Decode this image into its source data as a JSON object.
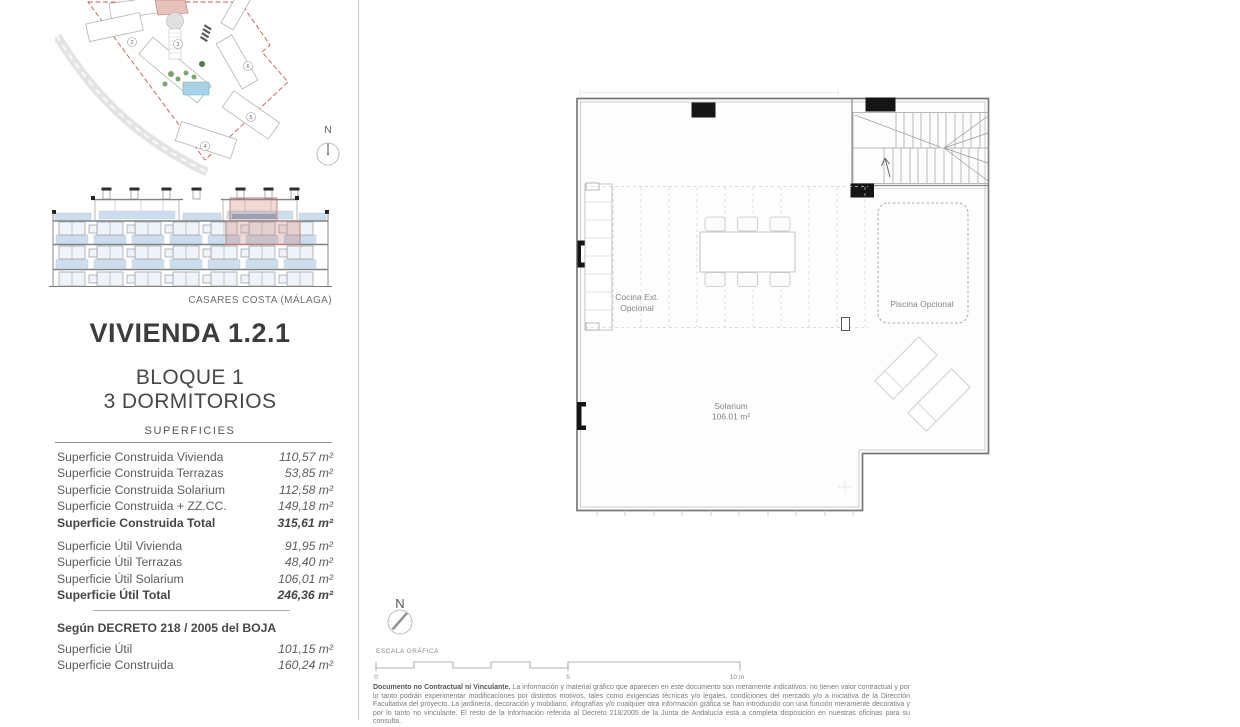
{
  "location": "CASARES COSTA (MÁLAGA)",
  "title": "VIVIENDA 1.2.1",
  "subtitle_block": "BLOQUE 1",
  "subtitle_bedrooms": "3 DORMITORIOS",
  "surfaces": {
    "header": "SUPERFICIES",
    "built": [
      {
        "label": "Superficie Construida Vivienda",
        "value": "110,57 m²"
      },
      {
        "label": "Superficie Construida Terrazas",
        "value": "53,85 m²"
      },
      {
        "label": "Superficie Construida Solarium",
        "value": "112,58 m²"
      },
      {
        "label": "Superficie Construida + ZZ.CC.",
        "value": "149,18 m²"
      },
      {
        "label": "Superficie Construida Total",
        "value": "315,61 m²"
      }
    ],
    "useful": [
      {
        "label": "Superficie Útil Vivienda",
        "value": "91,95 m²"
      },
      {
        "label": "Superficie Útil Terrazas",
        "value": "48,40 m²"
      },
      {
        "label": "Superficie Útil Solarium",
        "value": "106,01 m²"
      },
      {
        "label": "Superficie Útil Total",
        "value": "246,36 m²"
      }
    ],
    "decree": {
      "heading": "Según DECRETO 218 / 2005 del BOJA",
      "rows": [
        {
          "label": "Superficie Útil",
          "value": "101,15 m²"
        },
        {
          "label": "Superficie Construida",
          "value": "160,24 m²"
        }
      ]
    }
  },
  "site_plan": {
    "north": "N",
    "building_numbers": [
      "2",
      "3",
      "4",
      "5",
      "6"
    ]
  },
  "floor_plan": {
    "cocina_line1": "Cocina Ext.",
    "cocina_line2": "Opcional",
    "piscina": "Piscina Opcional",
    "solarium_line1": "Solarium",
    "solarium_line2": "106.01 m²"
  },
  "scale": {
    "north": "N",
    "label": "ESCALA GRÁFICA",
    "tick0": "0",
    "tick5": "5",
    "tick10": "10 m"
  },
  "disclaimer": {
    "lead": "Documento no Contractual ni Vinculante.",
    "body": " La información y material gráfico que aparecen en este documento son meramente indicativos, no tienen valor contractual y por lo tanto podrán experimentar modificaciones por distintos motivos, tales como exigencias técnicas y/o legales, condiciones del mercado y/o a iniciativa de la Dirección Facultativa del proyecto. La jardinería, decoración y mobiliario, infografías y/o cualquier otra información gráfica se han introducido con una función meramente decorativa y por lo tanto no vinculante. El resto de la información referida al Decreto 218/2005 de la Junta de Andalucía está a completa disposición en nuestras oficinas para su consulta."
  },
  "colors": {
    "accent_red": "#c25a52",
    "highlight_pink": "#e7c2bd",
    "glass_blue": "#bcd4e7",
    "pool_blue": "#a6d3e8"
  }
}
